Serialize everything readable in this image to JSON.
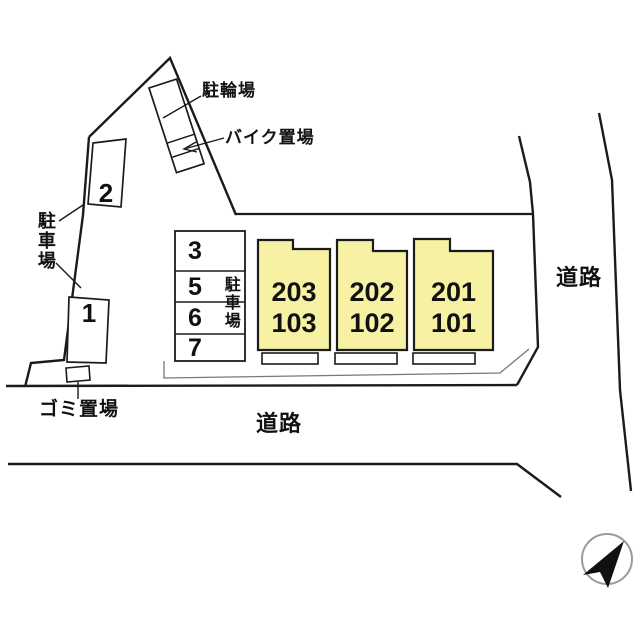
{
  "plan": {
    "labels": {
      "bicycle_parking": "駐輪場",
      "motorcycle_parking": "バイク置場",
      "parking_side": "駐車場",
      "parking_table": "駐車場",
      "garbage_area": "ゴミ置場",
      "road_right": "道路",
      "road_bottom": "道路"
    },
    "parking_numbers": {
      "side": [
        "2",
        "1"
      ],
      "table": [
        "3",
        "5",
        "6",
        "7"
      ]
    },
    "buildings": [
      {
        "upper": "203",
        "lower": "103"
      },
      {
        "upper": "202",
        "lower": "102"
      },
      {
        "upper": "201",
        "lower": "101"
      }
    ],
    "colors": {
      "building_fill": "#F6F1A3",
      "line": "#1b1b1b",
      "apron_line": "#777777",
      "compass_ring": "#9a9a9a"
    },
    "compass_direction": "north-east"
  }
}
